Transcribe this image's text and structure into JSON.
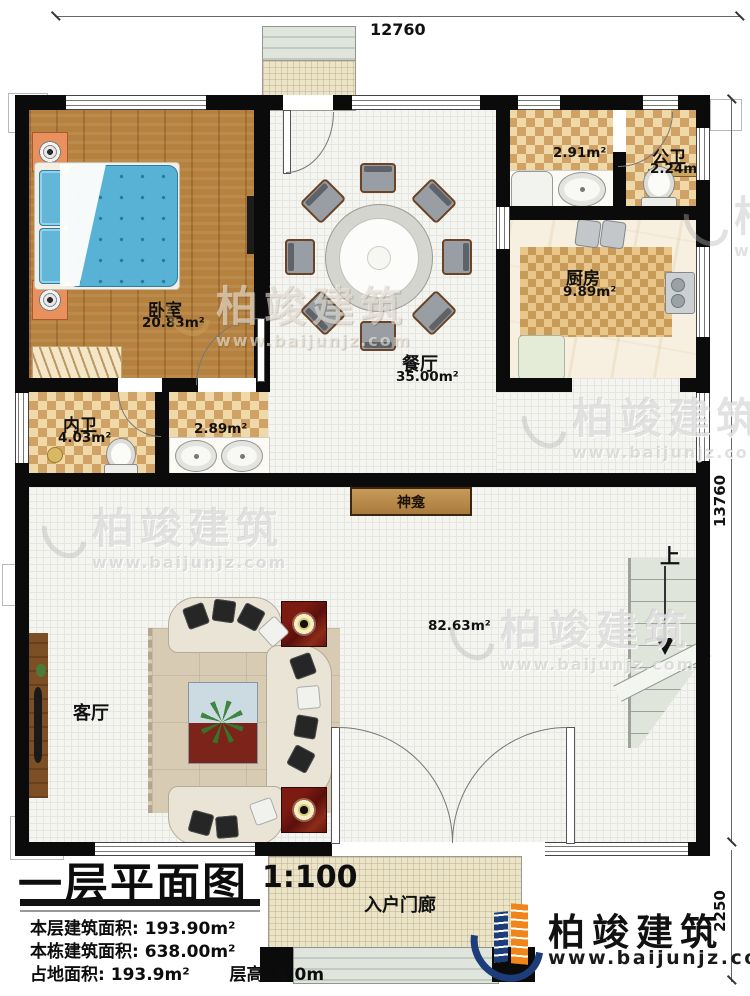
{
  "dimensions": {
    "top": "12760",
    "right": "13760",
    "right_lower": "2250"
  },
  "watermark": {
    "name": "柏竣建筑",
    "url": "www.baijunjz.com"
  },
  "brand": {
    "name": "柏竣建筑",
    "url": "www.baijunjz.com"
  },
  "rooms": {
    "bedroom": {
      "name": "卧室",
      "area": "20.83m²"
    },
    "dining": {
      "name": "餐厅",
      "area": "35.00m²"
    },
    "wash": {
      "area": "2.91m²"
    },
    "public_bath": {
      "name": "公卫",
      "area": "2.24m²"
    },
    "kitchen": {
      "name": "厨房",
      "area": "9.89m²"
    },
    "inner_bath": {
      "name": "内卫",
      "area": "4.03m²"
    },
    "vanity": {
      "area": "2.89m²"
    },
    "living": {
      "name": "客厅",
      "area": "82.63m²"
    },
    "shrine": {
      "name": "神龛"
    },
    "stair": {
      "up": "上"
    },
    "porch": {
      "name": "入户门廊"
    }
  },
  "title_block": {
    "title": "一层平面图",
    "scale": "1:100",
    "row1_label": "本层建筑面积:",
    "row1_value": "193.90m²",
    "row2_label": "本栋建筑面积:",
    "row2_value": "638.00m²",
    "row3a_label": "占地面积:",
    "row3a_value": "193.9m²",
    "row3b_label": "层高:",
    "row3b_value": "4.0m"
  }
}
